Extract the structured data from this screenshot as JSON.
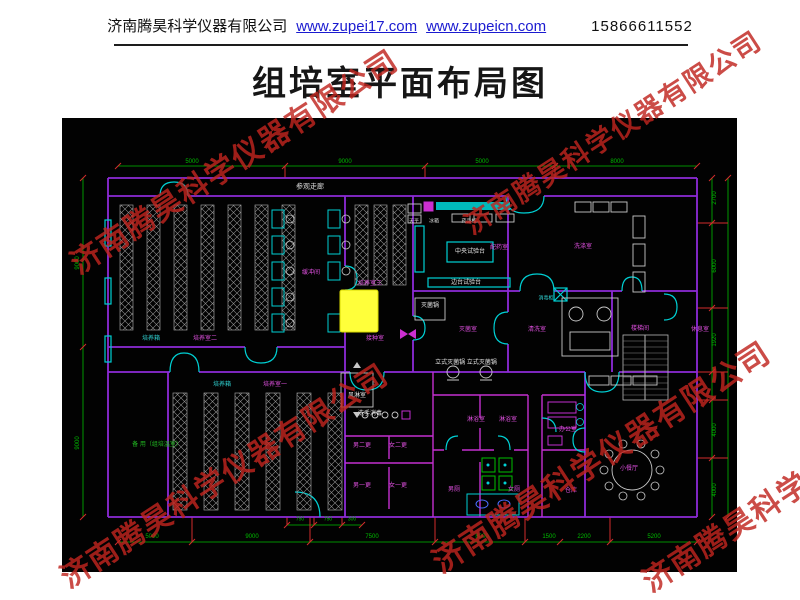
{
  "header": {
    "company": "济南腾昊科学仪器有限公司",
    "link1": "www.zupei17.com",
    "link2": "www.zupeicn.com",
    "phone": "15866611552"
  },
  "title": "组培室平面布局图",
  "watermark": {
    "text": "济南腾昊科学仪器有限公司",
    "color": "#c0251f",
    "items": [
      {
        "x": 72,
        "y": 242,
        "s": 30
      },
      {
        "x": 466,
        "y": 206,
        "s": 27
      },
      {
        "x": 62,
        "y": 556,
        "s": 30
      },
      {
        "x": 434,
        "y": 540,
        "s": 31
      },
      {
        "x": 644,
        "y": 560,
        "s": 30
      }
    ]
  },
  "plan": {
    "texts": [
      {
        "k": "room",
        "t": "参观走廊",
        "x": 248,
        "y": 69,
        "c": "#d8d8d8",
        "s": 7
      },
      {
        "k": "room",
        "t": "缓冲间",
        "x": 249,
        "y": 155,
        "c": "#e050e0",
        "s": 6
      },
      {
        "k": "room",
        "t": "培养室三",
        "x": 308,
        "y": 166,
        "c": "#e050e0",
        "s": 6
      },
      {
        "k": "room",
        "t": "接种室",
        "x": 313,
        "y": 221,
        "c": "#e050e0",
        "s": 6
      },
      {
        "k": "equip",
        "t": "培养箱",
        "x": 89,
        "y": 221,
        "c": "#30d5d5",
        "s": 6
      },
      {
        "k": "room",
        "t": "培养室二",
        "x": 143,
        "y": 221,
        "c": "#e050e0",
        "s": 6
      },
      {
        "k": "equip",
        "t": "培养箱",
        "x": 160,
        "y": 267,
        "c": "#30d5d5",
        "s": 6
      },
      {
        "k": "room",
        "t": "培养室一",
        "x": 213,
        "y": 267,
        "c": "#e050e0",
        "s": 6
      },
      {
        "k": "equip",
        "t": "风淋室",
        "x": 295,
        "y": 278,
        "c": "#e8e8e8",
        "s": 6
      },
      {
        "k": "equip",
        "t": "洗手消毒",
        "x": 308,
        "y": 296,
        "c": "#e8e8e8",
        "s": 6
      },
      {
        "k": "room",
        "t": "男二更",
        "x": 300,
        "y": 328,
        "c": "#e050e0",
        "s": 6
      },
      {
        "k": "room",
        "t": "女二更",
        "x": 336,
        "y": 328,
        "c": "#e050e0",
        "s": 6
      },
      {
        "k": "room",
        "t": "男一更",
        "x": 300,
        "y": 368,
        "c": "#e050e0",
        "s": 6
      },
      {
        "k": "room",
        "t": "女一更",
        "x": 336,
        "y": 368,
        "c": "#e050e0",
        "s": 6
      },
      {
        "k": "equip",
        "t": "天平",
        "x": 352,
        "y": 104,
        "c": "#d8d8d8",
        "s": 5
      },
      {
        "k": "equip",
        "t": "冰箱",
        "x": 372,
        "y": 104,
        "c": "#d8d8d8",
        "s": 5
      },
      {
        "k": "equip",
        "t": "药品柜",
        "x": 407,
        "y": 104,
        "c": "#d8d8d8",
        "s": 5
      },
      {
        "k": "equip",
        "t": "中央试验台",
        "x": 408,
        "y": 134,
        "c": "#e8e8e8",
        "s": 6
      },
      {
        "k": "room",
        "t": "配药室",
        "x": 437,
        "y": 130,
        "c": "#e050e0",
        "s": 6
      },
      {
        "k": "equip",
        "t": "边台试验台",
        "x": 404,
        "y": 165,
        "c": "#e8e8e8",
        "s": 6
      },
      {
        "k": "room",
        "t": "洗涤室",
        "x": 521,
        "y": 129,
        "c": "#e050e0",
        "s": 6
      },
      {
        "k": "equip",
        "t": "灭菌锅",
        "x": 368,
        "y": 188,
        "c": "#e8e8e8",
        "s": 6
      },
      {
        "k": "room",
        "t": "灭菌室",
        "x": 406,
        "y": 212,
        "c": "#e050e0",
        "s": 6
      },
      {
        "k": "room",
        "t": "清洗室",
        "x": 475,
        "y": 212,
        "c": "#e050e0",
        "s": 6
      },
      {
        "k": "equip",
        "t": "消毒柜",
        "x": 484,
        "y": 181,
        "c": "#30d5d5",
        "s": 5
      },
      {
        "k": "equip",
        "t": "立式灭菌锅 立式灭菌锅",
        "x": 404,
        "y": 245,
        "c": "#e8e8e8",
        "s": 6
      },
      {
        "k": "room",
        "t": "楼梯间",
        "x": 578,
        "y": 211,
        "c": "#e050e0",
        "s": 6
      },
      {
        "k": "room",
        "t": "休息室",
        "x": 638,
        "y": 212,
        "c": "#e050e0",
        "s": 6
      },
      {
        "k": "room",
        "t": "淋浴室",
        "x": 414,
        "y": 302,
        "c": "#e050e0",
        "s": 6
      },
      {
        "k": "room",
        "t": "淋浴室",
        "x": 446,
        "y": 302,
        "c": "#e050e0",
        "s": 6
      },
      {
        "k": "room",
        "t": "办公室",
        "x": 506,
        "y": 312,
        "c": "#e050e0",
        "s": 6
      },
      {
        "k": "room",
        "t": "男厕",
        "x": 392,
        "y": 372,
        "c": "#e050e0",
        "s": 6
      },
      {
        "k": "room",
        "t": "女厕",
        "x": 452,
        "y": 372,
        "c": "#e050e0",
        "s": 6
      },
      {
        "k": "room",
        "t": "仓库",
        "x": 509,
        "y": 373,
        "c": "#e050e0",
        "s": 6
      },
      {
        "k": "room",
        "t": "小餐厅",
        "x": 567,
        "y": 351,
        "c": "#e050e0",
        "s": 6
      },
      {
        "k": "room",
        "t": "备 用（组培温室）",
        "x": 95,
        "y": 327,
        "c": "#22bb22",
        "s": 6
      },
      {
        "k": "dim",
        "t": "5000",
        "x": 130,
        "y": 44,
        "c": "#00bd00",
        "s": 6
      },
      {
        "k": "dim",
        "t": "9000",
        "x": 283,
        "y": 44,
        "c": "#00bd00",
        "s": 6
      },
      {
        "k": "dim",
        "t": "5000",
        "x": 420,
        "y": 44,
        "c": "#00bd00",
        "s": 6
      },
      {
        "k": "dim",
        "t": "8000",
        "x": 555,
        "y": 44,
        "c": "#00bd00",
        "s": 6
      },
      {
        "k": "dim",
        "t": "9000",
        "x": 16,
        "y": 145,
        "c": "#00bd00",
        "s": 6,
        "rot": 1
      },
      {
        "k": "dim",
        "t": "9000",
        "x": 16,
        "y": 325,
        "c": "#00bd00",
        "s": 6,
        "rot": 1
      },
      {
        "k": "dim",
        "t": "2700",
        "x": 653,
        "y": 80,
        "c": "#00bd00",
        "s": 6,
        "rot": 1
      },
      {
        "k": "dim",
        "t": "6000",
        "x": 653,
        "y": 148,
        "c": "#00bd00",
        "s": 6,
        "rot": 1
      },
      {
        "k": "dim",
        "t": "1920",
        "x": 653,
        "y": 222,
        "c": "#00bd00",
        "s": 6,
        "rot": 1
      },
      {
        "k": "dim",
        "t": "4000",
        "x": 653,
        "y": 312,
        "c": "#00bd00",
        "s": 6,
        "rot": 1
      },
      {
        "k": "dim",
        "t": "4000",
        "x": 653,
        "y": 372,
        "c": "#00bd00",
        "s": 6,
        "rot": 1
      },
      {
        "k": "dim",
        "t": "750",
        "x": 238,
        "y": 402,
        "c": "#00bd00",
        "s": 5
      },
      {
        "k": "dim",
        "t": "750",
        "x": 266,
        "y": 402,
        "c": "#00bd00",
        "s": 5
      },
      {
        "k": "dim",
        "t": "300",
        "x": 290,
        "y": 402,
        "c": "#00bd00",
        "s": 5
      },
      {
        "k": "dim",
        "t": "5000",
        "x": 90,
        "y": 419,
        "c": "#00bd00",
        "s": 6
      },
      {
        "k": "dim",
        "t": "9000",
        "x": 190,
        "y": 419,
        "c": "#00bd00",
        "s": 6
      },
      {
        "k": "dim",
        "t": "7500",
        "x": 310,
        "y": 419,
        "c": "#00bd00",
        "s": 6
      },
      {
        "k": "dim",
        "t": "8000",
        "x": 420,
        "y": 419,
        "c": "#00bd00",
        "s": 6
      },
      {
        "k": "dim",
        "t": "1500",
        "x": 487,
        "y": 419,
        "c": "#00bd00",
        "s": 6
      },
      {
        "k": "dim",
        "t": "2200",
        "x": 522,
        "y": 419,
        "c": "#00bd00",
        "s": 6
      },
      {
        "k": "dim",
        "t": "5200",
        "x": 592,
        "y": 419,
        "c": "#00bd00",
        "s": 6
      }
    ]
  }
}
